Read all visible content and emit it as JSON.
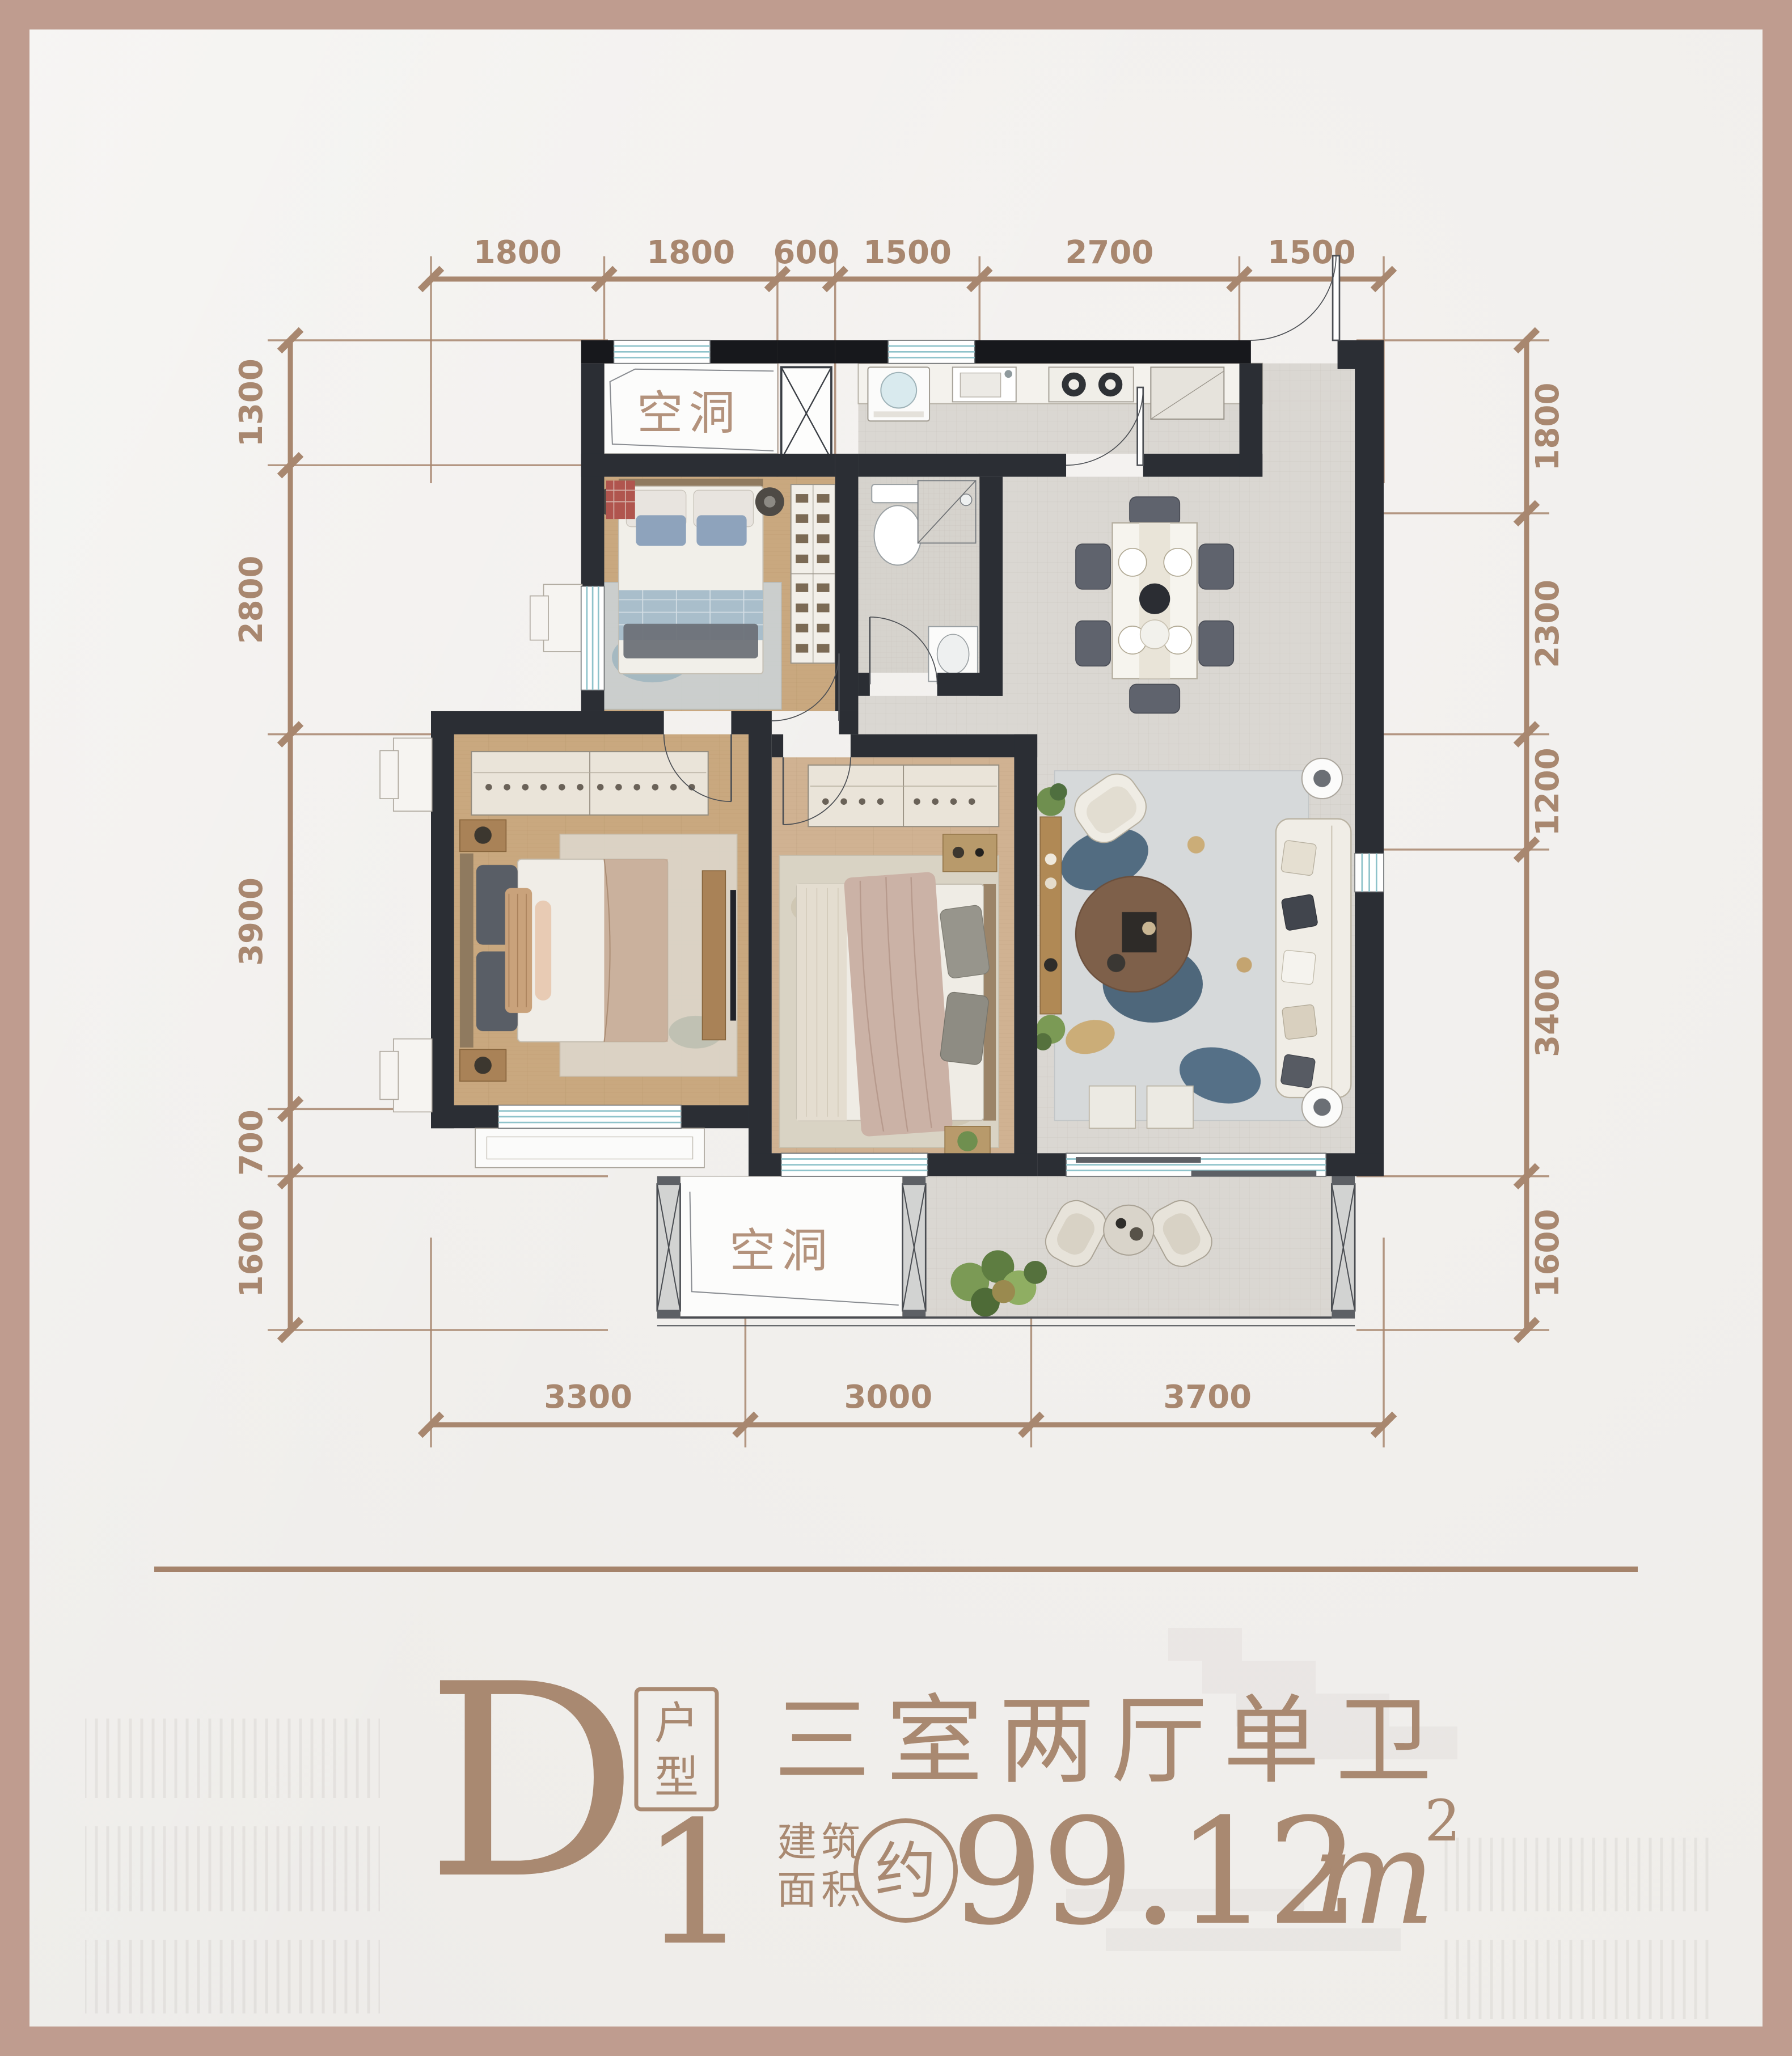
{
  "meta": {
    "type": "floorplan-card",
    "frame_color": "#bf9c8f",
    "background": "#f1efed"
  },
  "plan": {
    "dim_color": "#a8876f",
    "wall_color": "#2b2e34",
    "void_label_top": "空洞",
    "void_label_bottom": "空洞",
    "dimensions_mm": {
      "top": [
        1800,
        1800,
        600,
        1500,
        2700,
        1500
      ],
      "left": [
        1300,
        2800,
        3900,
        700,
        1600
      ],
      "right": [
        1800,
        2300,
        1200,
        3400,
        1600
      ],
      "bottom": [
        3300,
        3000,
        3700
      ]
    }
  },
  "title": {
    "unit_letter": "D",
    "unit_number": "1",
    "unit_type_box_char1": "户",
    "unit_type_box_char2": "型",
    "headline": "三室两厅单卫",
    "area_label_line1": "建筑",
    "area_label_line2": "面积",
    "approx_char": "约",
    "area_value": "99.12",
    "area_unit": "m",
    "area_sup": "2",
    "accent_color": "#a98971"
  }
}
